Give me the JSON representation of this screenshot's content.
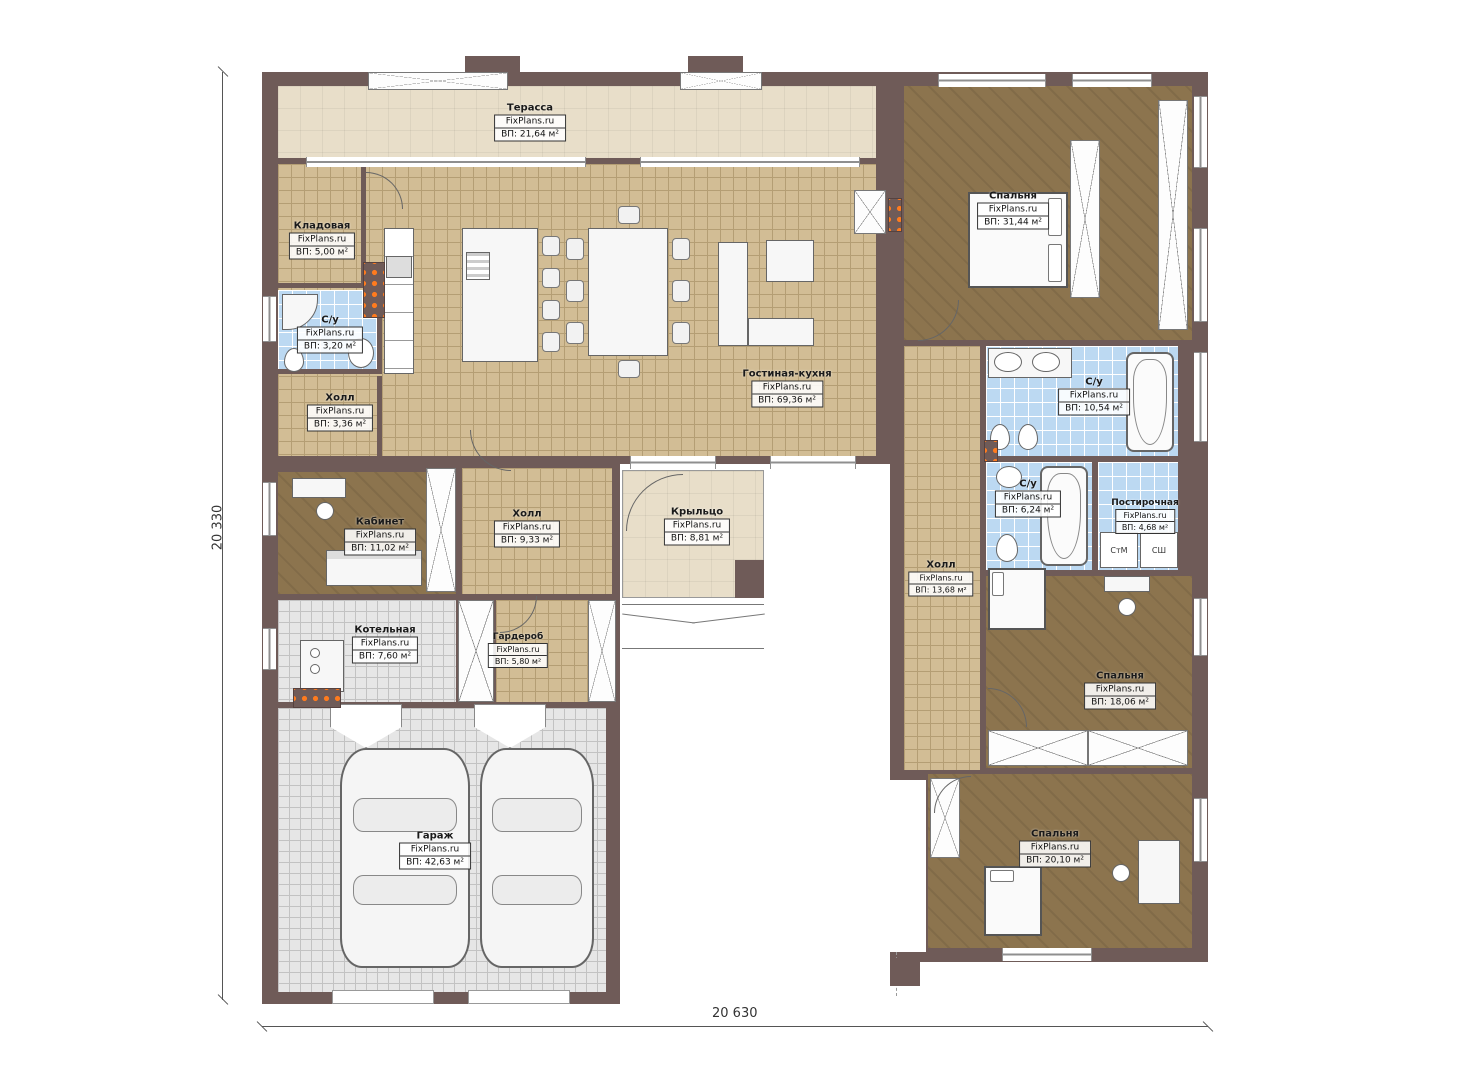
{
  "plan": {
    "brand": "FixPlans.ru",
    "dim_width": "20 630",
    "dim_height": "20 330",
    "rooms": {
      "terrace": {
        "name": "Терасса",
        "area": "ВП: 21,64 м²"
      },
      "storage": {
        "name": "Кладовая",
        "area": "ВП: 5,00 м²"
      },
      "bath_entry": {
        "name": "С/у",
        "area": "ВП: 3,20 м²"
      },
      "hall_entry": {
        "name": "Холл",
        "area": "ВП: 3,36 м²"
      },
      "living_kitchen": {
        "name": "Гостиная-кухня",
        "area": "ВП: 69,36 м²"
      },
      "bedroom_master": {
        "name": "Спальня",
        "area": "ВП: 31,44 м²"
      },
      "bath_master": {
        "name": "С/у",
        "area": "ВП: 10,54 м²"
      },
      "office": {
        "name": "Кабинет",
        "area": "ВП: 11,02 м²"
      },
      "hall_center": {
        "name": "Холл",
        "area": "ВП: 9,33 м²"
      },
      "porch": {
        "name": "Крыльцо",
        "area": "ВП: 8,81 м²"
      },
      "bath_guest": {
        "name": "С/у",
        "area": "ВП: 6,24 м²"
      },
      "laundry": {
        "name": "Постирочная",
        "area": "ВП: 4,68 м²"
      },
      "hall_right": {
        "name": "Холл",
        "area": "ВП: 13,68 м²"
      },
      "boiler": {
        "name": "Котельная",
        "area": "ВП: 7,60 м²"
      },
      "wardrobe": {
        "name": "Гардероб",
        "area": "ВП: 5,80 м²"
      },
      "bedroom_middle": {
        "name": "Спальня",
        "area": "ВП: 18,06 м²"
      },
      "garage": {
        "name": "Гараж",
        "area": "ВП: 42,63 м²"
      },
      "bedroom_lower": {
        "name": "Спальня",
        "area": "ВП: 20,10 м²"
      }
    },
    "appliances": {
      "washer": "СтМ",
      "dryer": "СШ"
    },
    "colors": {
      "wall": "#6f5b58",
      "floor_tan": "#d2bd95",
      "floor_brown": "#8c744e",
      "floor_blue": "#bcd9f2",
      "floor_gray": "#e6e6e6",
      "floor_beige": "#e8dec9",
      "radiator": "#ff7b1e"
    }
  }
}
